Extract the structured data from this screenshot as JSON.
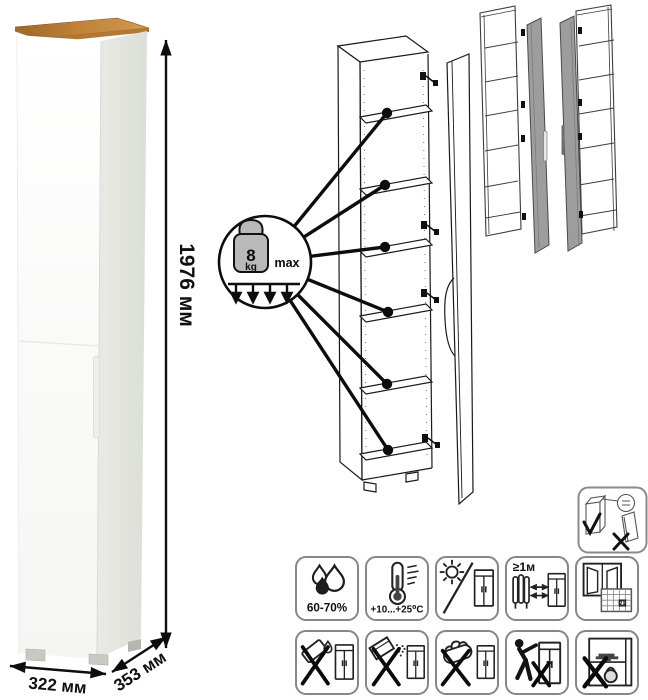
{
  "page": {
    "background": "#ffffff"
  },
  "product_photo": {
    "dimensions": {
      "height": "1976 мм",
      "width": "322 мм",
      "depth": "353 мм"
    },
    "colors": {
      "top_panel_wood": "#bd8142",
      "body": "#fbfbfa",
      "side_shade": "#e4e6e0"
    }
  },
  "shelf_load_diagram": {
    "weight_value": "8",
    "weight_unit": "kg",
    "qualifier": "max",
    "shelves_indicated": 6
  },
  "door_variants": {
    "icons": [
      "door-hinged-right",
      "door-hinged-left"
    ],
    "door_color": "#9d9d9d"
  },
  "safety_icon": {
    "name": "anti-tip-wall-fixing"
  },
  "care_icons": {
    "row1": [
      {
        "name": "humidity-range",
        "label": "60-70%"
      },
      {
        "name": "temperature-range",
        "label": "+10...+25⁰C"
      },
      {
        "name": "no-direct-sunlight",
        "label": ""
      },
      {
        "name": "distance-from-heat",
        "label": "≥1м"
      },
      {
        "name": "ventilation-calendar",
        "calendar_day": "21"
      }
    ],
    "row2": [
      {
        "name": "no-aggressive-liquids"
      },
      {
        "name": "no-abrasive-powders"
      },
      {
        "name": "no-rough-scrubbing"
      },
      {
        "name": "no-dragging"
      },
      {
        "name": "no-overloading"
      }
    ]
  }
}
